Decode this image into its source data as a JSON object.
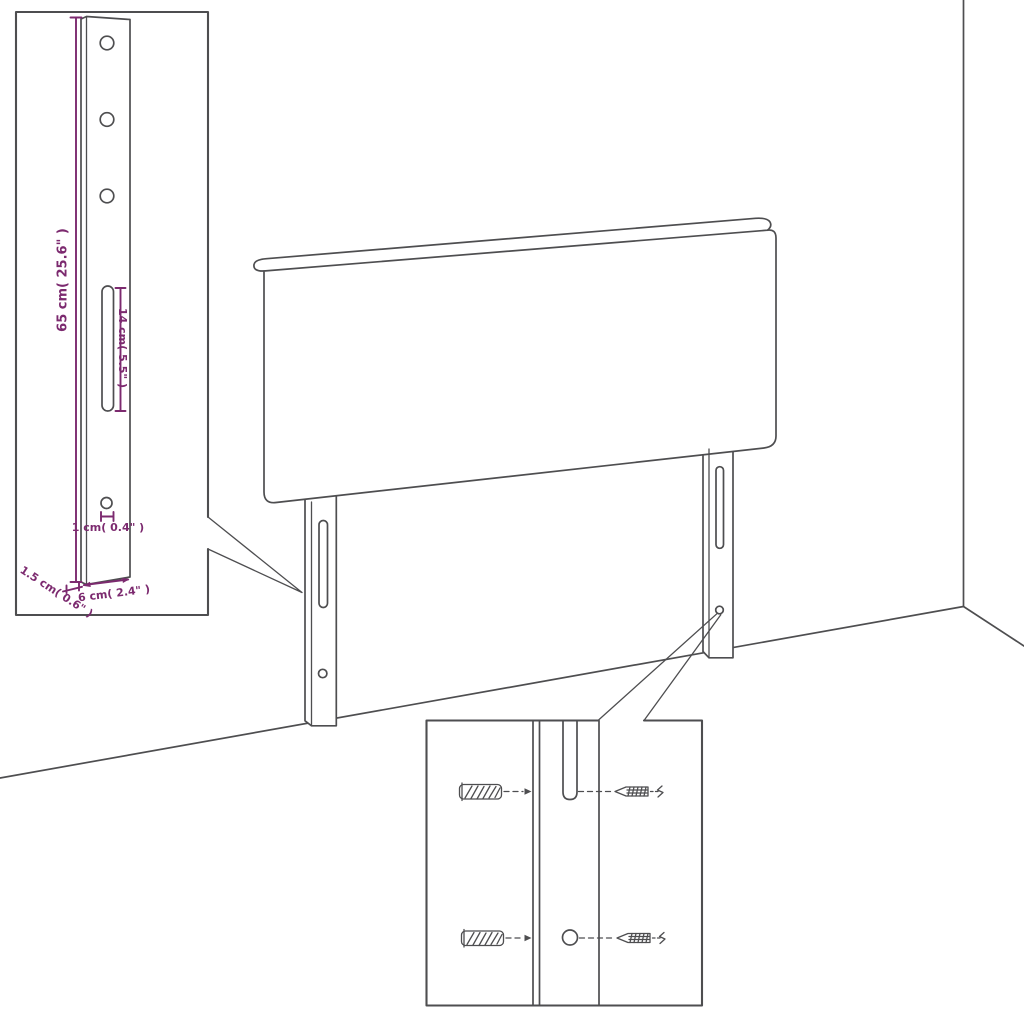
{
  "diagram": {
    "title": "Headboard wall-mounting dimension diagram",
    "colors": {
      "line": "#4e4e50",
      "dimension": "#7c2a6f",
      "background": "#ffffff"
    },
    "labels": {
      "leg_height": "65 cm( 25.6\" )",
      "slot_length": "14 cm( 5.5\" )",
      "hole_diameter": "1 cm( 0.4\" )",
      "leg_thickness": "1.5 cm( 0.6\" )",
      "leg_width": "6 cm( 2.4\" )"
    },
    "parts": [
      "headboard-panel",
      "left-mounting-leg",
      "right-mounting-leg",
      "leg-detail-callout",
      "hardware-detail-callout",
      "wall-anchor",
      "screw",
      "wall-corner",
      "floor-line"
    ],
    "icons": {
      "wall_anchor": "hatched-cylinder-glyph",
      "screw": "pointed-screw-glyph",
      "mounting_slot": "rounded-vertical-slot",
      "mounting_hole": "small-circle"
    }
  }
}
